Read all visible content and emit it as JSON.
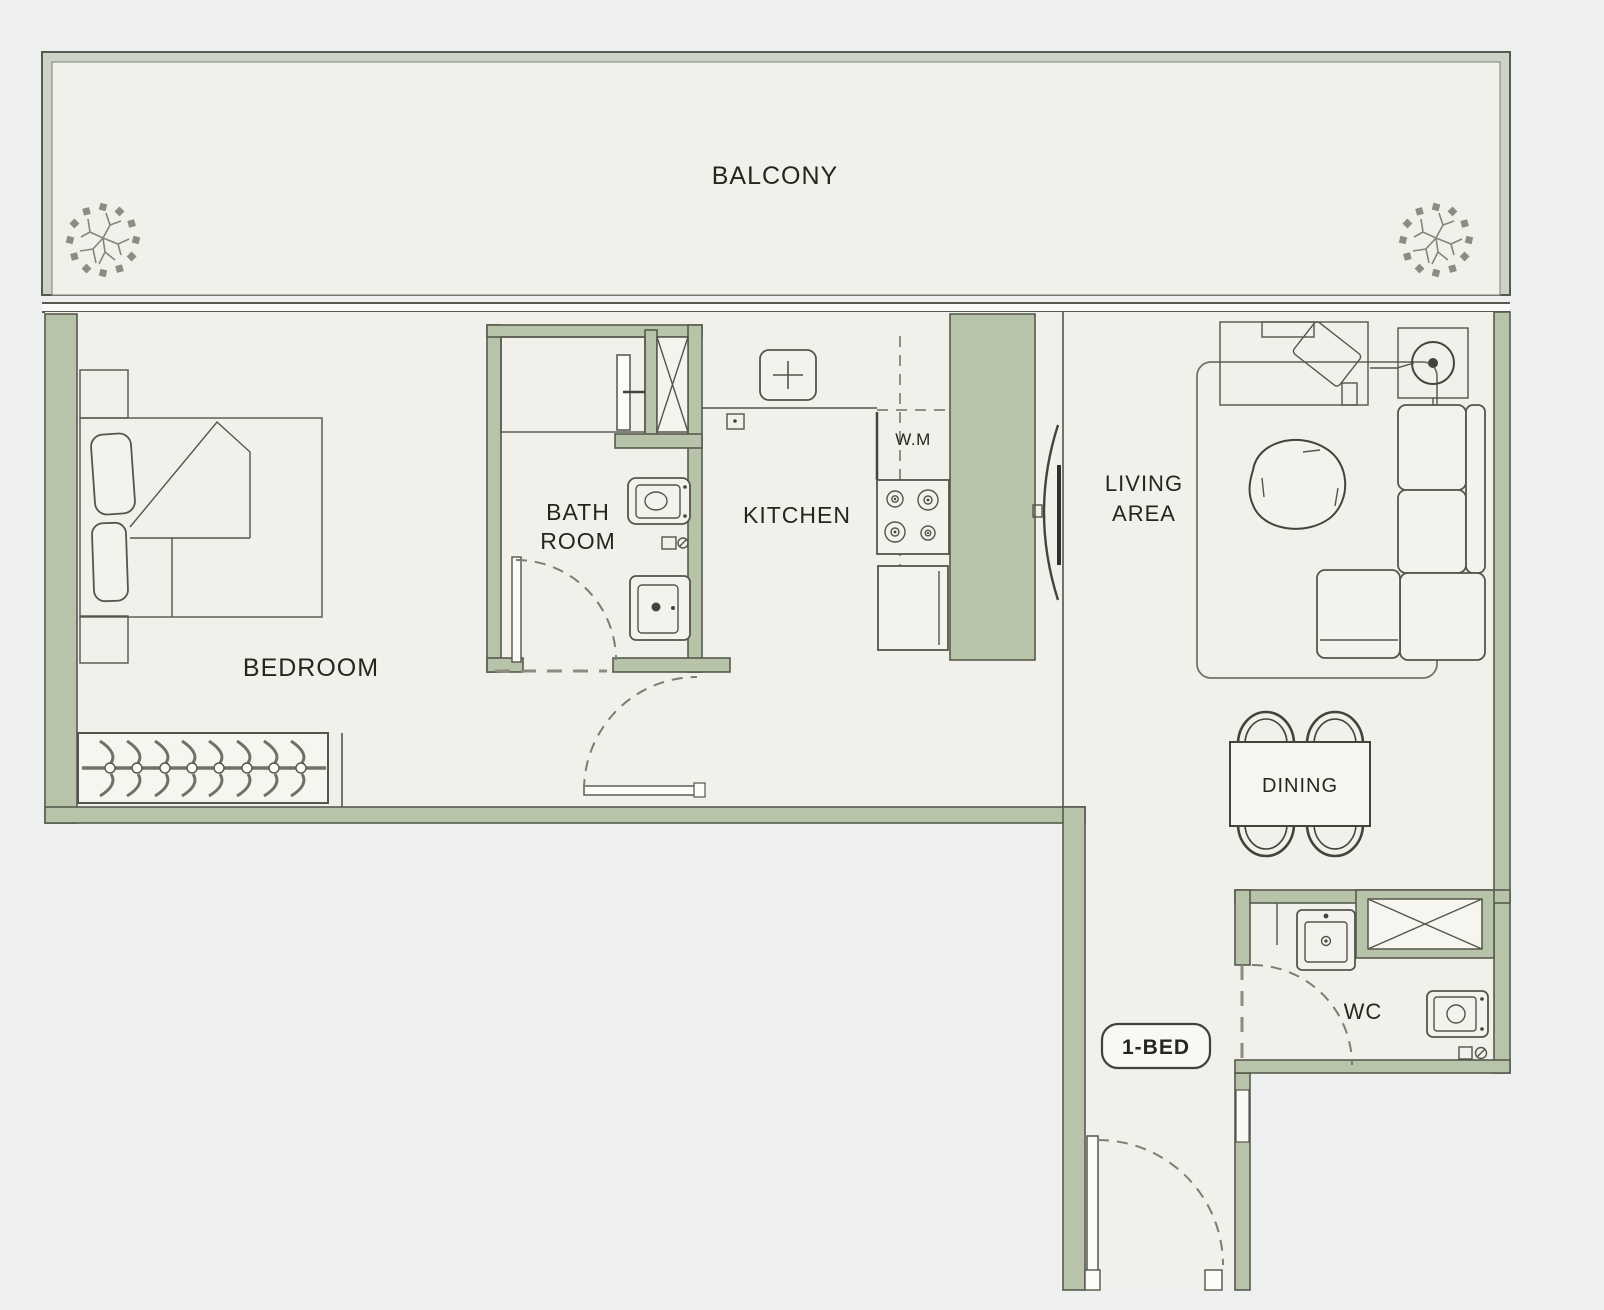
{
  "unit": {
    "badge": "1-BED"
  },
  "labels": {
    "balcony": "BALCONY",
    "bedroom": "BEDROOM",
    "bath_line1": "BATH",
    "bath_line2": "ROOM",
    "kitchen": "KITCHEN",
    "washing_machine": "W.M",
    "living_line1": "LIVING",
    "living_line2": "AREA",
    "dining": "DINING",
    "wc": "WC"
  },
  "colors": {
    "background": "#edf0ef",
    "floor": "#f1f0ea",
    "wall_green": "#b8c4a9",
    "balcony_wall": "#ccd2c5",
    "outline": "#565a4e",
    "text": "#26261f"
  },
  "icons": {
    "plant": "plant-icon",
    "shaft": "cross-box-icon",
    "door": "door-swing-arc-icon",
    "hanger": "clothes-hanger-icon",
    "stove": "four-burner-stove-icon",
    "sink": "sink-basin-icon",
    "toilet": "toilet-icon",
    "shower": "shower-glass-icon",
    "lamp": "floor-lamp-icon"
  }
}
